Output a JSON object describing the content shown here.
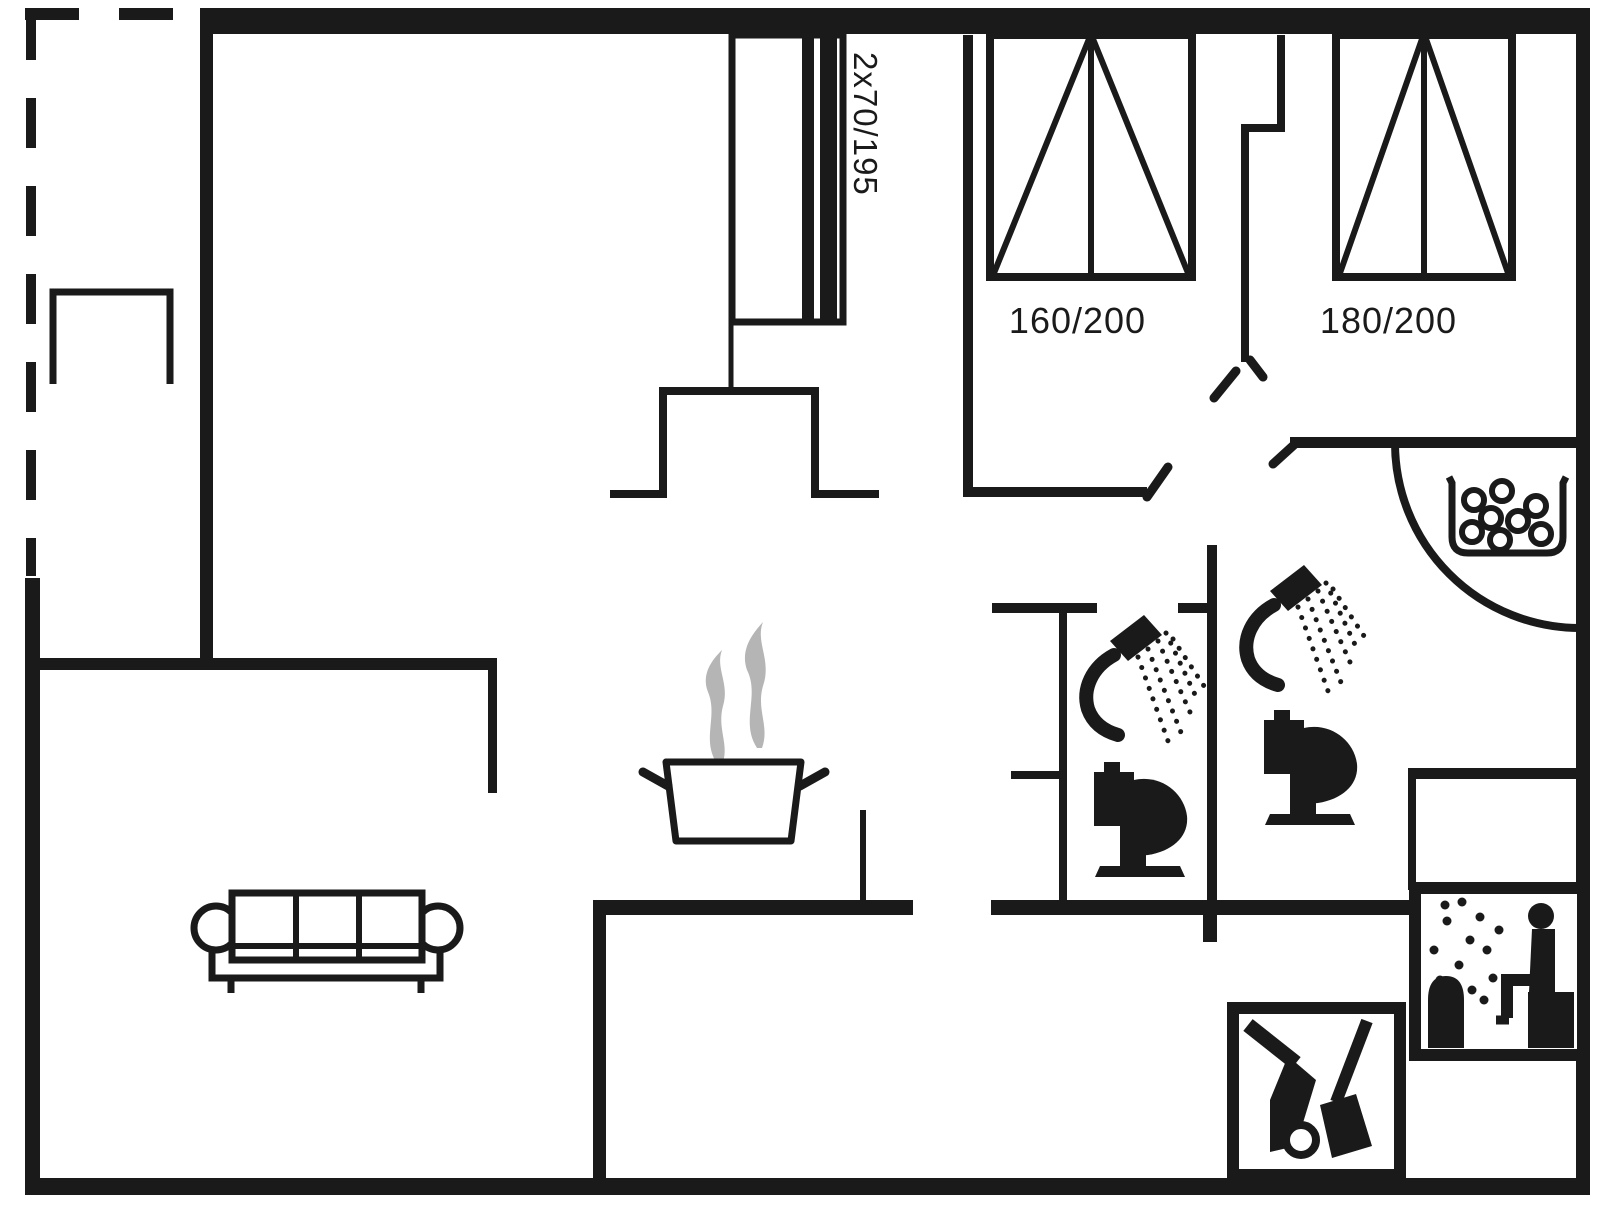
{
  "page": {
    "title": "Holiday home floor plan",
    "type": "floor-plan-diagram"
  },
  "palette": {
    "line": "#1a1a1a",
    "steam": "#b5b5b5",
    "background": "#ffffff"
  },
  "labels": {
    "bunk_bed_size": "2x70/195",
    "double_bed_left_size": "160/200",
    "double_bed_right_size": "180/200"
  },
  "icons": [
    {
      "name": "bunk-bed-icon",
      "label": "2x70/195"
    },
    {
      "name": "double-bed-icon",
      "label": "160/200"
    },
    {
      "name": "double-bed-icon",
      "label": "180/200"
    },
    {
      "name": "wardrobe-icon"
    },
    {
      "name": "sofa-icon"
    },
    {
      "name": "cooking-pot-icon"
    },
    {
      "name": "steam-icon"
    },
    {
      "name": "shower-icon"
    },
    {
      "name": "shower-icon"
    },
    {
      "name": "toilet-icon"
    },
    {
      "name": "toilet-icon"
    },
    {
      "name": "whirlpool-icon"
    },
    {
      "name": "sauna-icon"
    },
    {
      "name": "cleaning-equipment-icon"
    },
    {
      "name": "door-swing-arc"
    }
  ]
}
